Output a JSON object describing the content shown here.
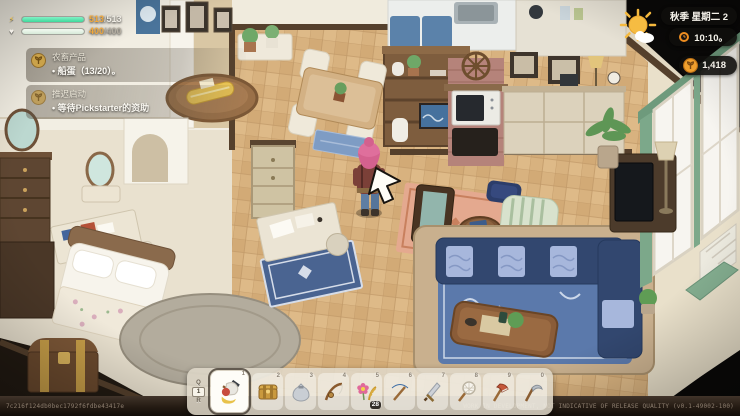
{
  "hud": {
    "stats": {
      "energy": {
        "current": "513",
        "max": "513",
        "percent": 100
      },
      "health": {
        "current": "400",
        "max": "400",
        "percent": 100
      }
    },
    "quests": [
      {
        "title": "农畜产品",
        "objective": "船蛋（13/20）。"
      },
      {
        "title": "推迟启动",
        "objective": "等待Pickstarter的资助"
      }
    ],
    "clock": {
      "season_day": "秋季 星期二 2",
      "time": "10:10。"
    },
    "currency": {
      "amount": "1,418"
    },
    "hotbar": {
      "prev_key": "Q",
      "page": "1",
      "next_key": "R",
      "slots": [
        {
          "key": "1",
          "item": "tool-bundle",
          "selected": true
        },
        {
          "key": "2",
          "item": "golden-chest",
          "selected": false
        },
        {
          "key": "3",
          "item": "gray-pouch",
          "selected": false
        },
        {
          "key": "4",
          "item": "fishing-rod",
          "selected": false
        },
        {
          "key": "5",
          "item": "flower-bundle",
          "count": "28",
          "selected": false
        },
        {
          "key": "6",
          "item": "pickaxe",
          "selected": false
        },
        {
          "key": "7",
          "item": "sword",
          "selected": false
        },
        {
          "key": "8",
          "item": "bug-net",
          "selected": false
        },
        {
          "key": "9",
          "item": "axe",
          "selected": false
        },
        {
          "key": "0",
          "item": "scythe",
          "selected": false
        }
      ]
    }
  },
  "footer": {
    "build_hash": "7c216f124db0bec1792f6fdbe43417e",
    "disclaimer": "WORK IN DEVELOPMENT, NOT INDICATIVE OF RELEASE QUALITY (v0.1-49002-100)"
  },
  "colors": {
    "energy_fill": "#49e3a7",
    "health_fill": "#e6f4e8",
    "value_accent": "#f2a93c",
    "coin": "#f09c2e",
    "hotbar_bg": "#e0d9cb"
  }
}
